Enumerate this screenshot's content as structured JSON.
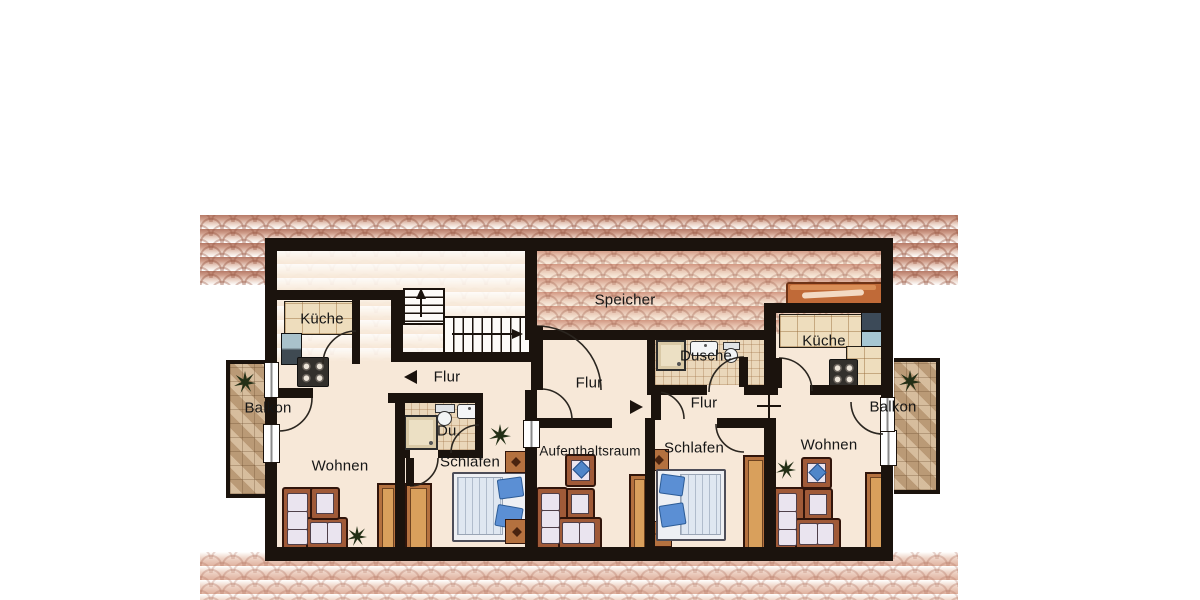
{
  "plan": {
    "type": "floor-plan",
    "labels": {
      "kueche_left": "Küche",
      "balkon_left": "Balkon",
      "flur_left": "Flur",
      "wohnen_left": "Wohnen",
      "du": "Du.",
      "schlafen_left": "Schlafen",
      "speicher": "Speicher",
      "flur_middle": "Flur",
      "aufenthaltsraum": "Aufenthaltsraum",
      "schlafen_middle": "Schlafen",
      "dusche": "Dusche",
      "flur_right": "Flur",
      "kueche_right": "Küche",
      "wohnen_right": "Wohnen",
      "balkon_right": "Balkon"
    },
    "annotations": {
      "flur_left_arrow": "arrow-left",
      "flur_middle_arrow": "arrow-right",
      "stairs_vertical_arrow": "arrow-up",
      "stairs_horizontal_arrow": "arrow-right",
      "wall_opening_marker": "cross"
    },
    "colors": {
      "wall": "#1b130d",
      "floor": "#f7e8d8",
      "roof_shingle": "#c58d7a",
      "balcony_tile": "#c7a987",
      "bath_tile": "#ead7ba",
      "wood": "#b4713f",
      "sofa_frame": "#a05a38",
      "cushion": "#eae4ef",
      "pillow_blue": "#4f86c9",
      "counter": "#eeddbd",
      "bench": "#c06a38"
    },
    "icons": {
      "plant": "plant-icon",
      "stove": "stove-icon",
      "fridge": "fridge-icon",
      "sink": "sink-icon",
      "toilet": "toilet-icon",
      "shower": "shower-icon",
      "stairs": "stairs-icon",
      "door_swing": "door-arc-icon"
    }
  }
}
